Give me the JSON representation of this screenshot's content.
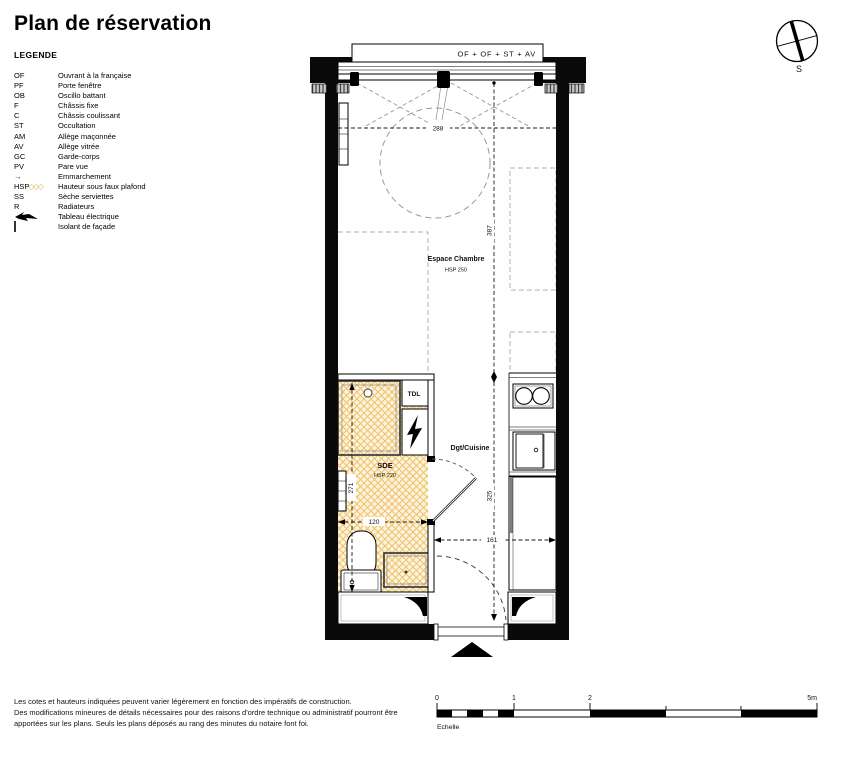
{
  "title": "Plan de réservation",
  "legend": {
    "heading": "LEGENDE",
    "hsp_hatch": "◇◇◇",
    "items": [
      {
        "code": "OF",
        "label": "Ouvrant à la française"
      },
      {
        "code": "PF",
        "label": "Porte fenêtre"
      },
      {
        "code": "OB",
        "label": "Oscillo battant"
      },
      {
        "code": "F",
        "label": "Châssis fixe"
      },
      {
        "code": "C",
        "label": "Châssis coulissant"
      },
      {
        "code": "ST",
        "label": "Occultation"
      },
      {
        "code": "AM",
        "label": "Allège maçonnée"
      },
      {
        "code": "AV",
        "label": "Allège vitrée"
      },
      {
        "code": "GC",
        "label": "Garde-corps"
      },
      {
        "code": "PV",
        "label": "Pare vue"
      },
      {
        "code": "→",
        "label": "Emmarchement"
      },
      {
        "code": "HSP",
        "label": "Hauteur sous faux plafond"
      },
      {
        "code": "SS",
        "label": "Sèche serviettes"
      },
      {
        "code": "R",
        "label": "Radiateurs"
      },
      {
        "code": "",
        "label": "Tableau électrique"
      },
      {
        "code": "",
        "label": "Isolant de façade"
      }
    ]
  },
  "plan": {
    "window_label": "OF + OF + ST + AV",
    "rooms": {
      "chambre": {
        "name": "Espace Chambre",
        "hsp": "HSP 250"
      },
      "sde": {
        "name": "SDE",
        "hsp": "HSP 220"
      },
      "degagement": {
        "name": "Dgt/Cuisine"
      },
      "tdl": "TDL"
    },
    "dims": {
      "window_width": "288",
      "chambre_length": "387",
      "lower_length": "325",
      "sde_length": "271",
      "sde_width": "120",
      "entry_width": "161"
    },
    "compass": {
      "south": "S"
    }
  },
  "scalebar": {
    "t0": "0",
    "t1": "1",
    "t2": "2",
    "t5": "5m",
    "caption": "Echelle"
  },
  "footer": {
    "line1": "Les cotes et hauteurs indiquées peuvent varier légèrement en fonction des impératifs de construction.",
    "line2": "Des modifications mineures de détails nécessaires pour des raisons d'ordre technique ou administratif pourront être",
    "line3": "apportées sur les plans. Seuls les plans déposés au rang des minutes du notaire font foi."
  },
  "colors": {
    "wall": "#000000",
    "hatch_line": "#eec06a",
    "hatch_bg": "#fdf4de",
    "accent_hsp": "#e8b04a"
  }
}
